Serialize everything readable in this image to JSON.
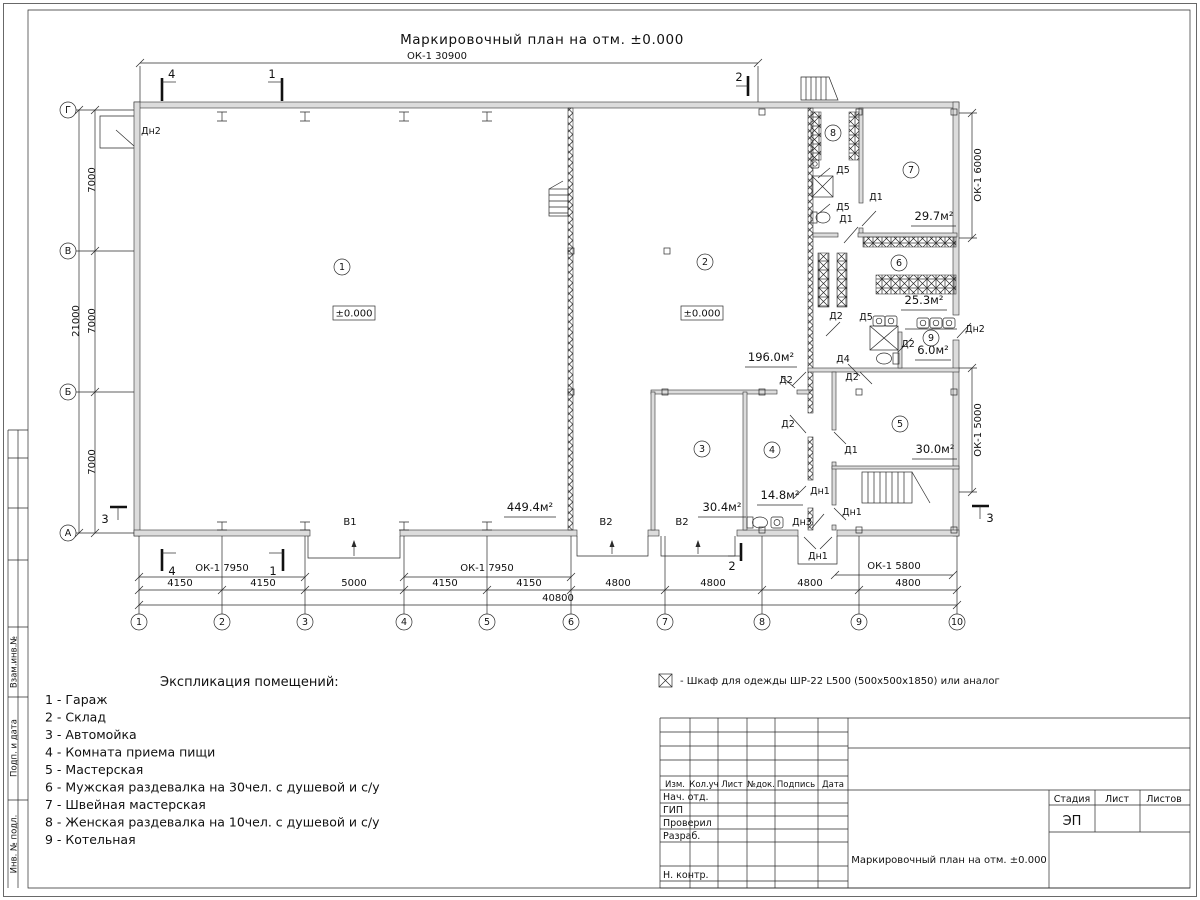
{
  "sheet_title": "Маркировочный план на отм. ±0.000",
  "dims": {
    "top": "ОК-1 30900",
    "ok7950": "ОК-1 7950",
    "ok5800": "ОК-1 5800",
    "ok6000": "ОК-1 6000",
    "ok5000": "ОК-1 5000",
    "d4150": "4150",
    "d5000": "5000",
    "d4800": "4800",
    "total": "40800",
    "d7000": "7000",
    "total_left": "21000"
  },
  "axes": {
    "c1": "1",
    "c2": "2",
    "c3": "3",
    "c4": "4",
    "c5": "5",
    "c6": "6",
    "c7": "7",
    "c8": "8",
    "c9": "9",
    "c10": "10",
    "rG": "Г",
    "rV": "В",
    "rB": "Б",
    "rA": "А"
  },
  "marks": {
    "m1": "1",
    "m2": "2",
    "m3": "3",
    "m4": "4"
  },
  "rooms": {
    "n1": "1",
    "n2": "2",
    "n3": "3",
    "n4": "4",
    "n5": "5",
    "n6": "6",
    "n7": "7",
    "n8": "8",
    "n9": "9",
    "a1": "449.4м²",
    "a2": "196.0м²",
    "a3": "30.4м²",
    "a4": "14.8м²",
    "a5": "30.0м²",
    "a6": "25.3м²",
    "a7": "29.7м²",
    "a9": "6.0м²",
    "lvl": "±0.000"
  },
  "doors": {
    "d1": "Д1",
    "d2": "Д2",
    "d4": "Д4",
    "d5": "Д5",
    "dn1": "Дн1",
    "dn2": "Дн2",
    "dn3": "Дн3",
    "v1": "В1",
    "v2": "В2"
  },
  "legend": {
    "title": "Экспликация помещений:",
    "items": [
      "1 - Гараж",
      "2 - Склад",
      "3 - Автомойка",
      "4 - Комната приема пищи",
      "5 - Мастерская",
      "6 - Мужская раздевалка на 30чел. с душевой и с/у",
      "7 - Швейная мастерская",
      "8 - Женская раздевалка на 10чел. с душевой и с/у",
      "9 - Котельная"
    ]
  },
  "note": "- Шкаф для одежды ШР-22 L500 (500x500x1850) или аналог",
  "stamp": {
    "izm": "Изм.",
    "koluch": "Кол.уч",
    "list": "Лист",
    "ndok": "№док.",
    "podpis": "Подпись",
    "data": "Дата",
    "nach": "Нач. отд.",
    "gip": "ГИП",
    "prov": "Проверил",
    "razrab": "Разраб.",
    "nkontr": "Н. контр.",
    "stadia": "Стадия",
    "list2": "Лист",
    "listov": "Листов",
    "stage": "ЭП",
    "doc_title": "Маркировочный план на отм. ±0.000"
  },
  "side": {
    "vzam": "Взам.инв.№",
    "podp": "Подп. и дата",
    "inv": "Инв. № подл."
  }
}
